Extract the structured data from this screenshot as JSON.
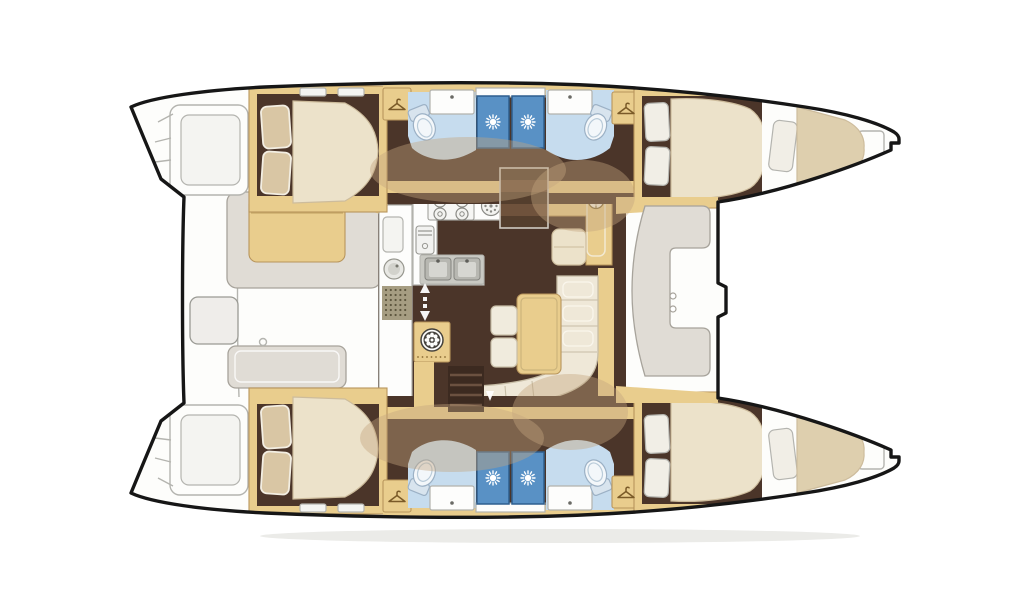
{
  "document": {
    "kind": "catamaran interior floor plan",
    "orientation": "bow-right, twin hulls top and bottom, salon amidships",
    "visible_text": "none"
  },
  "palette": {
    "page_bg": "#ffffff",
    "boat_white": "#fdfdfb",
    "outline": "#161616",
    "gray_line": "#b4b4af",
    "ghost_fill": "#f4f4f1",
    "tan": "#e9cd8d",
    "tan_stroke": "#b8955c",
    "cream": "#ece2ca",
    "cream_stroke": "#cdbc9c",
    "pillow_tan": "#d9c6a4",
    "pillow_stroke": "#f3eee2",
    "pillow_white": "#f1eee6",
    "floor_dark": "#4b3529",
    "blob": "rgba(196,164,126,0.42)",
    "bath_blue": "#c6dcee",
    "shower_blue": "#5991c5",
    "shower_stroke": "#2e5e8e",
    "counter_white": "#fdfdfc",
    "counter_stroke": "#b2b2ad",
    "sink_gray": "#c9c9c3",
    "furn_gray": "#e0dcd5",
    "furn_stroke": "#a7a39b",
    "grille": "#a69d82",
    "grille_dot": "#5e573f",
    "berth_tan": "#decfae",
    "toilet_bowl": "#f3f7fa",
    "toilet_tank": "#d8e4ee",
    "toilet_stroke": "#9cb1c5",
    "stair_dark": "#543e2d",
    "stair_light": "#6f523c",
    "shadow": "#ebebe8",
    "drum_dark": "#45423c"
  },
  "icons": {
    "shower": "sunburst-jet",
    "wardrobe": "clothes-hanger",
    "hull_steps": "up-down-arrows",
    "washing_machine": "drum-circle",
    "stove": "four-burners-plus-round-hob",
    "nav_instrument": "compass-dial",
    "floor_mat": "dot-grid-grille"
  },
  "regions": [
    {
      "id": "port-transom-steps",
      "label": "swim steps (outline)"
    },
    {
      "id": "port-aft-cabin",
      "label": "double berth cabin"
    },
    {
      "id": "port-aft-head",
      "label": "head: toilet + sink + shower"
    },
    {
      "id": "port-fwd-head",
      "label": "head: toilet + sink + shower"
    },
    {
      "id": "port-fwd-cabin",
      "label": "double berth cabin"
    },
    {
      "id": "port-bow-berth",
      "label": "bow berth"
    },
    {
      "id": "starboard-transom-steps",
      "label": "swim steps (outline)"
    },
    {
      "id": "starboard-aft-cabin",
      "label": "double berth cabin"
    },
    {
      "id": "starboard-aft-head",
      "label": "head: toilet + sink + shower"
    },
    {
      "id": "starboard-fwd-head",
      "label": "head: toilet + sink + shower"
    },
    {
      "id": "starboard-fwd-cabin",
      "label": "double berth cabin"
    },
    {
      "id": "starboard-bow-berth",
      "label": "bow berth"
    },
    {
      "id": "aft-cockpit",
      "label": "cockpit with benches and table"
    },
    {
      "id": "galley",
      "label": "L-galley: stove, oven, double sink"
    },
    {
      "id": "companionway",
      "label": "steps to deck"
    },
    {
      "id": "nav-station",
      "label": "chart table with instrument"
    },
    {
      "id": "salon",
      "label": "L-sofa with table and stools"
    },
    {
      "id": "forward-cockpit",
      "label": "C-shaped lounge bench"
    }
  ]
}
